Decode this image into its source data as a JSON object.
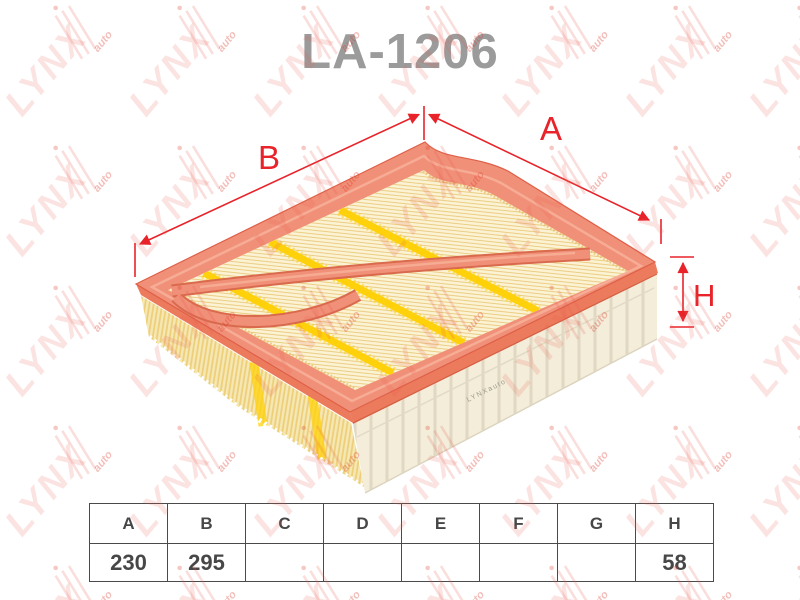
{
  "title": "LA-1206",
  "dimension_labels": {
    "a": "A",
    "b": "B",
    "h": "H"
  },
  "spec_table": {
    "headers": [
      "A",
      "B",
      "C",
      "D",
      "E",
      "F",
      "G",
      "H"
    ],
    "values": [
      "230",
      "295",
      "",
      "",
      "",
      "",
      "",
      "58"
    ]
  },
  "watermark": {
    "word": "LYNX",
    "sub": "auto"
  },
  "illustration": {
    "wall_print": "LYNXauto"
  },
  "colors": {
    "dimension_red": "#E8232A",
    "frame_orange": "#F19078",
    "media_cream": "#FBF3D4",
    "glue_yellow": "#FFD10A",
    "title_gray": "#9B9B9B"
  }
}
